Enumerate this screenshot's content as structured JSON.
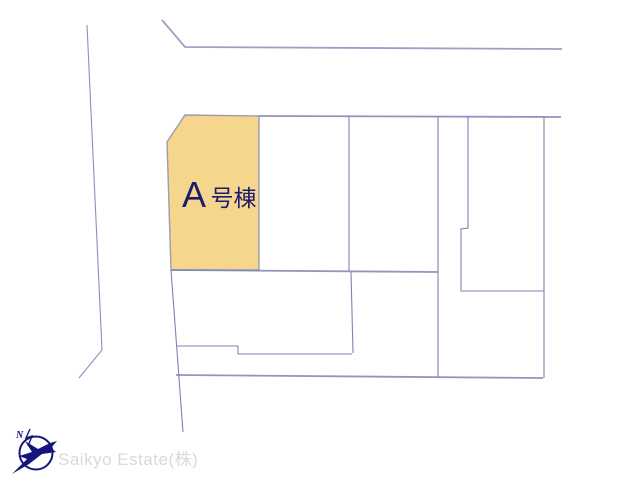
{
  "map": {
    "parcel_label": {
      "prefix": "A",
      "suffix": "号棟"
    },
    "colors": {
      "parcel_fill": "#f6d58c",
      "parcel_border": "#9c9cb4",
      "boundary_line": "#8181b4",
      "road_line": "#8d8dbe",
      "label_text": "#1c1c6e"
    }
  },
  "watermark": {
    "company": "Saikyo Estate(株)",
    "north_letter": "N",
    "text_color": "#d9d9d9",
    "logo_color": "#15157d"
  }
}
